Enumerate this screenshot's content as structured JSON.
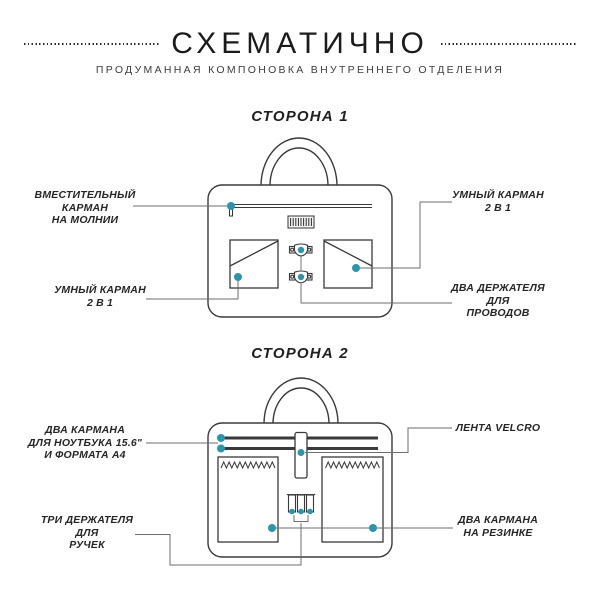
{
  "header": {
    "title": "СХЕМАТИЧНО",
    "subtitle": "ПРОДУМАННАЯ КОМПОНОВКА ВНУТРЕННЕГО ОТДЕЛЕНИЯ"
  },
  "colors": {
    "accent": "#2b96ab",
    "outline": "#3a3a3a",
    "leader": "#6e6e6e"
  },
  "side1": {
    "heading": "СТОРОНА 1",
    "labels": {
      "zip_pocket": {
        "lines": [
          "ВМЕСТИТЕЛЬНЫЙ",
          "КАРМАН",
          "НА МОЛНИИ"
        ]
      },
      "smart_pocket_right": {
        "lines": [
          "УМНЫЙ КАРМАН",
          "2 В 1"
        ]
      },
      "smart_pocket_left": {
        "lines": [
          "УМНЫЙ КАРМАН",
          "2 В 1"
        ]
      },
      "cable_holders": {
        "lines": [
          "ДВА ДЕРЖАТЕЛЯ",
          "ДЛЯ",
          "ПРОВОДОВ"
        ]
      }
    }
  },
  "side2": {
    "heading": "СТОРОНА 2",
    "labels": {
      "laptop_pockets": {
        "lines": [
          "ДВА КАРМАНА",
          "ДЛЯ НОУТБУКА 15.6\"",
          "И ФОРМАТА А4"
        ]
      },
      "velcro_strip": {
        "lines": [
          "ЛЕНТА VELCRO"
        ]
      },
      "pen_holders": {
        "lines": [
          "ТРИ ДЕРЖАТЕЛЯ",
          "ДЛЯ",
          "РУЧЕК"
        ]
      },
      "elastic_pockets": {
        "lines": [
          "ДВА КАРМАНА",
          "НА РЕЗИНКЕ"
        ]
      }
    }
  }
}
